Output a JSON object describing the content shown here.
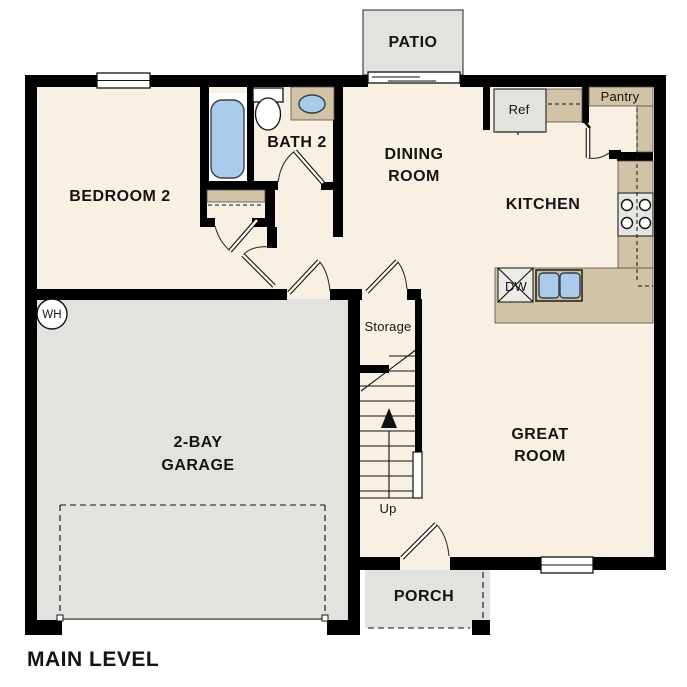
{
  "plan_title": "MAIN LEVEL",
  "rooms": {
    "bedroom2": "BEDROOM 2",
    "bath2": "BATH 2",
    "dining": [
      "DINING",
      "ROOM"
    ],
    "kitchen": "KITCHEN",
    "great_room": [
      "GREAT",
      "ROOM"
    ],
    "garage": [
      "2-BAY",
      "GARAGE"
    ],
    "patio": "PATIO",
    "porch": "PORCH",
    "storage": "Storage"
  },
  "labels": {
    "ref": "Ref",
    "pantry": "Pantry",
    "dw": "DW",
    "up": "Up",
    "wh": "WH"
  },
  "colors": {
    "floor": "#f7f0e3",
    "hard": "#e3e2df",
    "counter": "#d2c3a6",
    "fixture": "#aacbea",
    "wall": "#000000"
  }
}
